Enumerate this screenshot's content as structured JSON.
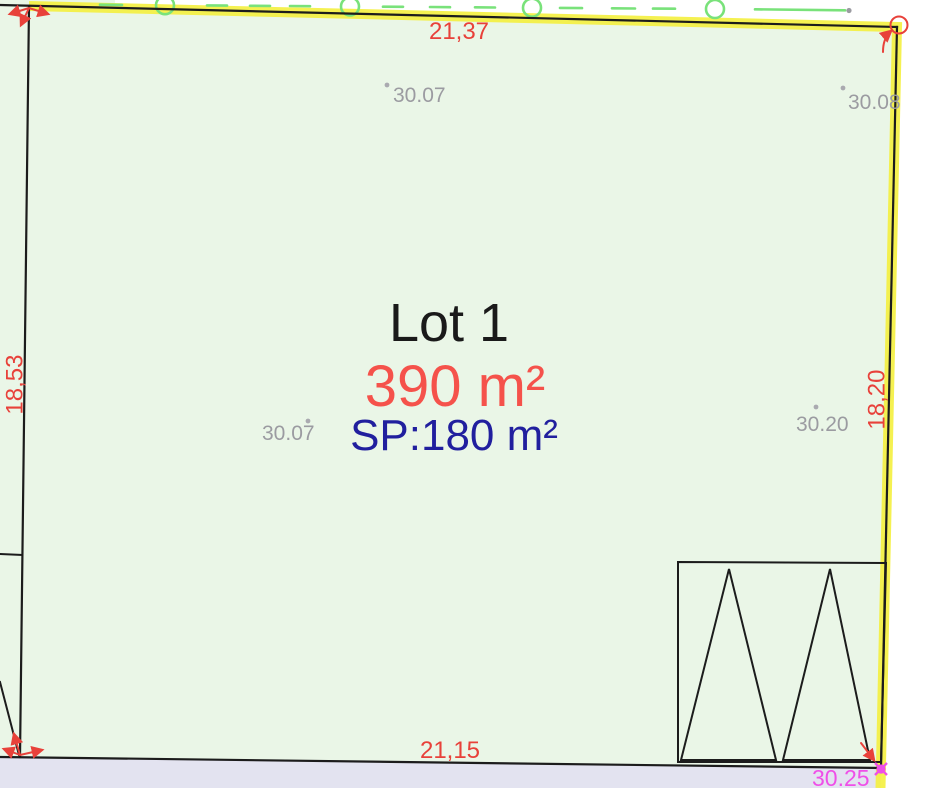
{
  "plan": {
    "lot_label": "Lot 1",
    "area_label": "390 m²",
    "surface_label": "SP:180 m²",
    "dimensions": {
      "top": "21,37",
      "bottom": "21,15",
      "left": "18,53",
      "right": "18,20"
    },
    "elevations": {
      "top_left": "30.07",
      "top_right": "30.08",
      "mid_left": "30.07",
      "mid_right": "30.20",
      "bottom_right": "30.25"
    },
    "colors": {
      "parcel_fill": "#eaf6e7",
      "road_fill": "#e3e3f0",
      "boundary_highlight_yellow": "#f4ef3e",
      "dimension_red": "#e8413a",
      "area_red": "#f5524b",
      "surface_blue": "#211f9e",
      "elevation_gray": "#9b9ba1",
      "utility_green": "#79e27a",
      "point_magenta": "#ef4fe8",
      "line_black": "#1c1c1c"
    }
  }
}
